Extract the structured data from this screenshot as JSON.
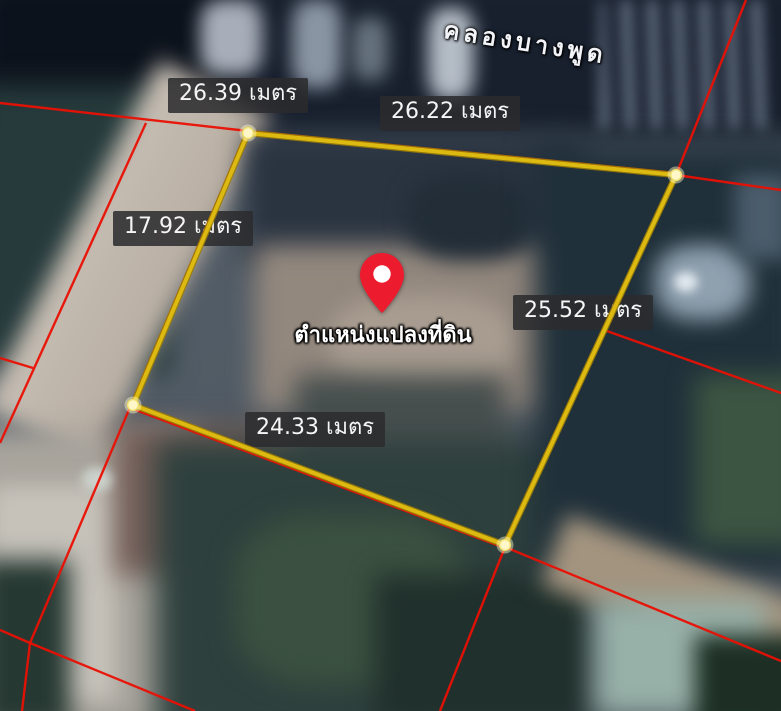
{
  "canvas": {
    "width": 781,
    "height": 711
  },
  "map": {
    "place_label": "คลองบางพูด",
    "pin": {
      "label": "ตำแหน่งแปลงที่ดิน",
      "color": "#ec1c2e"
    },
    "measurements": [
      {
        "label": "26.39 เมตร",
        "value": "26.39",
        "unit": "เมตร",
        "side": "top-left"
      },
      {
        "label": "26.22 เมตร",
        "value": "26.22",
        "unit": "เมตร",
        "side": "top-right"
      },
      {
        "label": "17.92 เมตร",
        "value": "17.92",
        "unit": "เมตร",
        "side": "left"
      },
      {
        "label": "25.52 เมตร",
        "value": "25.52",
        "unit": "เมตร",
        "side": "right"
      },
      {
        "label": "24.33 เมตร",
        "value": "24.33",
        "unit": "เมตร",
        "side": "bottom"
      }
    ]
  },
  "overlay": {
    "parcel_outline_color": "#dcba12",
    "parcel_outline_edge_color": "#9b7d06",
    "cadastral_color": "#ea1004",
    "vertex_fill": "#fff7c8",
    "vertex_stroke": "#efe06a",
    "vertices": [
      [
        248,
        133
      ],
      [
        676,
        175
      ],
      [
        505,
        545
      ],
      [
        133,
        405
      ]
    ],
    "cadastral_segments": [
      [
        0,
        103,
        248,
        131
      ],
      [
        146,
        123,
        0,
        443
      ],
      [
        0,
        358,
        33,
        368
      ],
      [
        248,
        131,
        676,
        173
      ],
      [
        674,
        177,
        504,
        544
      ],
      [
        133,
        409,
        505,
        548
      ],
      [
        246,
        133,
        131,
        405
      ],
      [
        746,
        0,
        676,
        175
      ],
      [
        676,
        175,
        781,
        190
      ],
      [
        604,
        330,
        781,
        393
      ],
      [
        505,
        547,
        781,
        661
      ],
      [
        505,
        547,
        440,
        711
      ],
      [
        131,
        405,
        30,
        643
      ],
      [
        0,
        630,
        30,
        643
      ],
      [
        30,
        643,
        22,
        711
      ],
      [
        30,
        643,
        195,
        711
      ]
    ]
  }
}
